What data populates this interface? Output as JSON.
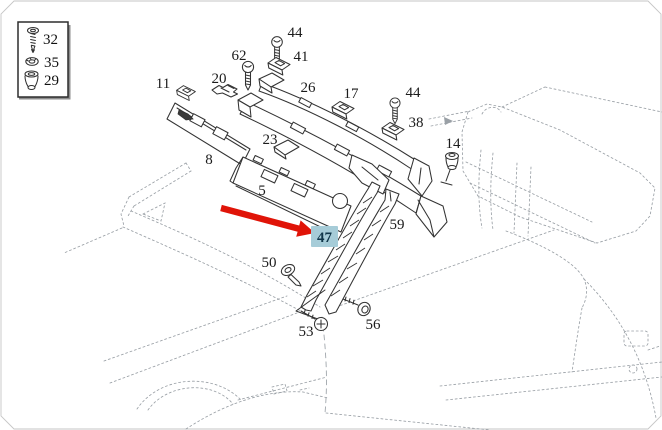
{
  "diagram": {
    "type": "vehicle-parts-diagram",
    "subject": "windshield-cowl-and-pillar-trim",
    "highlighted_part": "47",
    "highlight_bg": "#a6ccd8",
    "highlight_text": "#10364a",
    "arrow_color": "#e01408",
    "part_line_color": "#333333",
    "sketch_line_color": "#9aa0a6"
  },
  "legend": {
    "items": [
      {
        "label": "32",
        "icon": "countersunk-screw-icon"
      },
      {
        "label": "35",
        "icon": "washer-icon"
      },
      {
        "label": "29",
        "icon": "grommet-icon"
      }
    ]
  },
  "part_labels": {
    "p11": "11",
    "p20": "20",
    "p62": "62",
    "p44_top": "44",
    "p41": "41",
    "p26": "26",
    "p17": "17",
    "p44_right": "44",
    "p38": "38",
    "p14": "14",
    "p8": "8",
    "p23": "23",
    "p5": "5",
    "p59": "59",
    "p47": "47",
    "p50": "50",
    "p53": "53",
    "p56": "56"
  }
}
